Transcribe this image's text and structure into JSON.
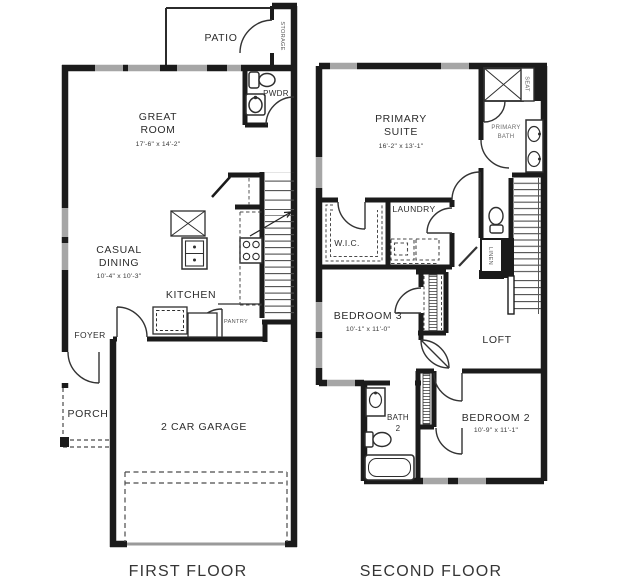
{
  "first_floor": {
    "title": "FIRST FLOOR",
    "rooms": {
      "patio": "PATIO",
      "storage": "STORAGE",
      "pwdr": "PWDR",
      "great_room": {
        "line1": "GREAT",
        "line2": "ROOM",
        "dims": "17'-6\" x 14'-2\""
      },
      "casual_dining": {
        "line1": "CASUAL",
        "line2": "DINING",
        "dims": "10'-4\" x 10'-3\""
      },
      "kitchen": "KITCHEN",
      "pantry": "PANTRY",
      "foyer": "FOYER",
      "porch": "PORCH",
      "garage": "2 CAR GARAGE"
    }
  },
  "second_floor": {
    "title": "SECOND FLOOR",
    "rooms": {
      "primary_suite": {
        "line1": "PRIMARY",
        "line2": "SUITE",
        "dims": "16'-2\" x 13'-1\""
      },
      "primary_bath": {
        "line1": "PRIMARY",
        "line2": "BATH"
      },
      "seat": "SEAT",
      "wic": "W.I.C.",
      "laundry": "LAUNDRY",
      "linen": "LINEN",
      "loft": "LOFT",
      "bedroom3": {
        "name": "BEDROOM 3",
        "dims": "10'-1\" x 11'-0\""
      },
      "bath2": {
        "line1": "BATH",
        "line2": "2"
      },
      "bedroom2": {
        "name": "BEDROOM 2",
        "dims": "10'-9\" x 11'-1\""
      }
    }
  },
  "colors": {
    "wall": "#1b1b1b",
    "window": "#a6a6a6",
    "fixture": "#2e2e2e",
    "dashed": "#4a4a4a",
    "label_dark": "#2d2d2d",
    "label_gray": "#5f5f5f",
    "garage_door": "#9a9a9a"
  }
}
